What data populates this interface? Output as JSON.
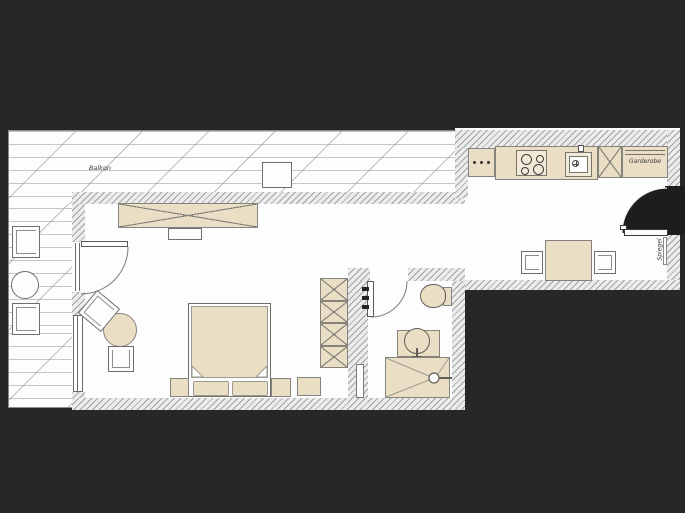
{
  "plan": {
    "type": "apartment-floor-plan",
    "labels": {
      "balcony": "Balkon",
      "wardrobe": "Garderobe",
      "mirror": "Spiegel"
    },
    "colors": {
      "background": "#272727",
      "floor": "#fdfdfd",
      "wall_fill": "#ececec",
      "wall_hatch_line": "#a2a2a2",
      "furniture_fill": "#eadfc4",
      "furniture_outline": "#84847c",
      "entry_swing_fill": "#1d1d1d"
    },
    "rooms": [
      {
        "name": "balcony",
        "label": "Balkon"
      },
      {
        "name": "living-sleeping-room",
        "label": ""
      },
      {
        "name": "bathroom",
        "label": ""
      },
      {
        "name": "kitchen-hall",
        "label": ""
      }
    ],
    "furniture": [
      "balcony-chair",
      "balcony-round-table",
      "balcony-side-table",
      "sideboard",
      "tv-board",
      "balcony-door",
      "double-bed",
      "pillow",
      "nightstand",
      "dresser",
      "wardrobe-column",
      "round-table",
      "chair",
      "bathroom-door",
      "toilet",
      "washbasin",
      "shower",
      "radiator",
      "towel-rail",
      "kitchen-counter",
      "cooktop",
      "kitchen-sink",
      "tall-cabinet",
      "wardrobe-garderobe",
      "dining-table",
      "dining-chair",
      "entrance-door",
      "wall-mirror"
    ]
  }
}
